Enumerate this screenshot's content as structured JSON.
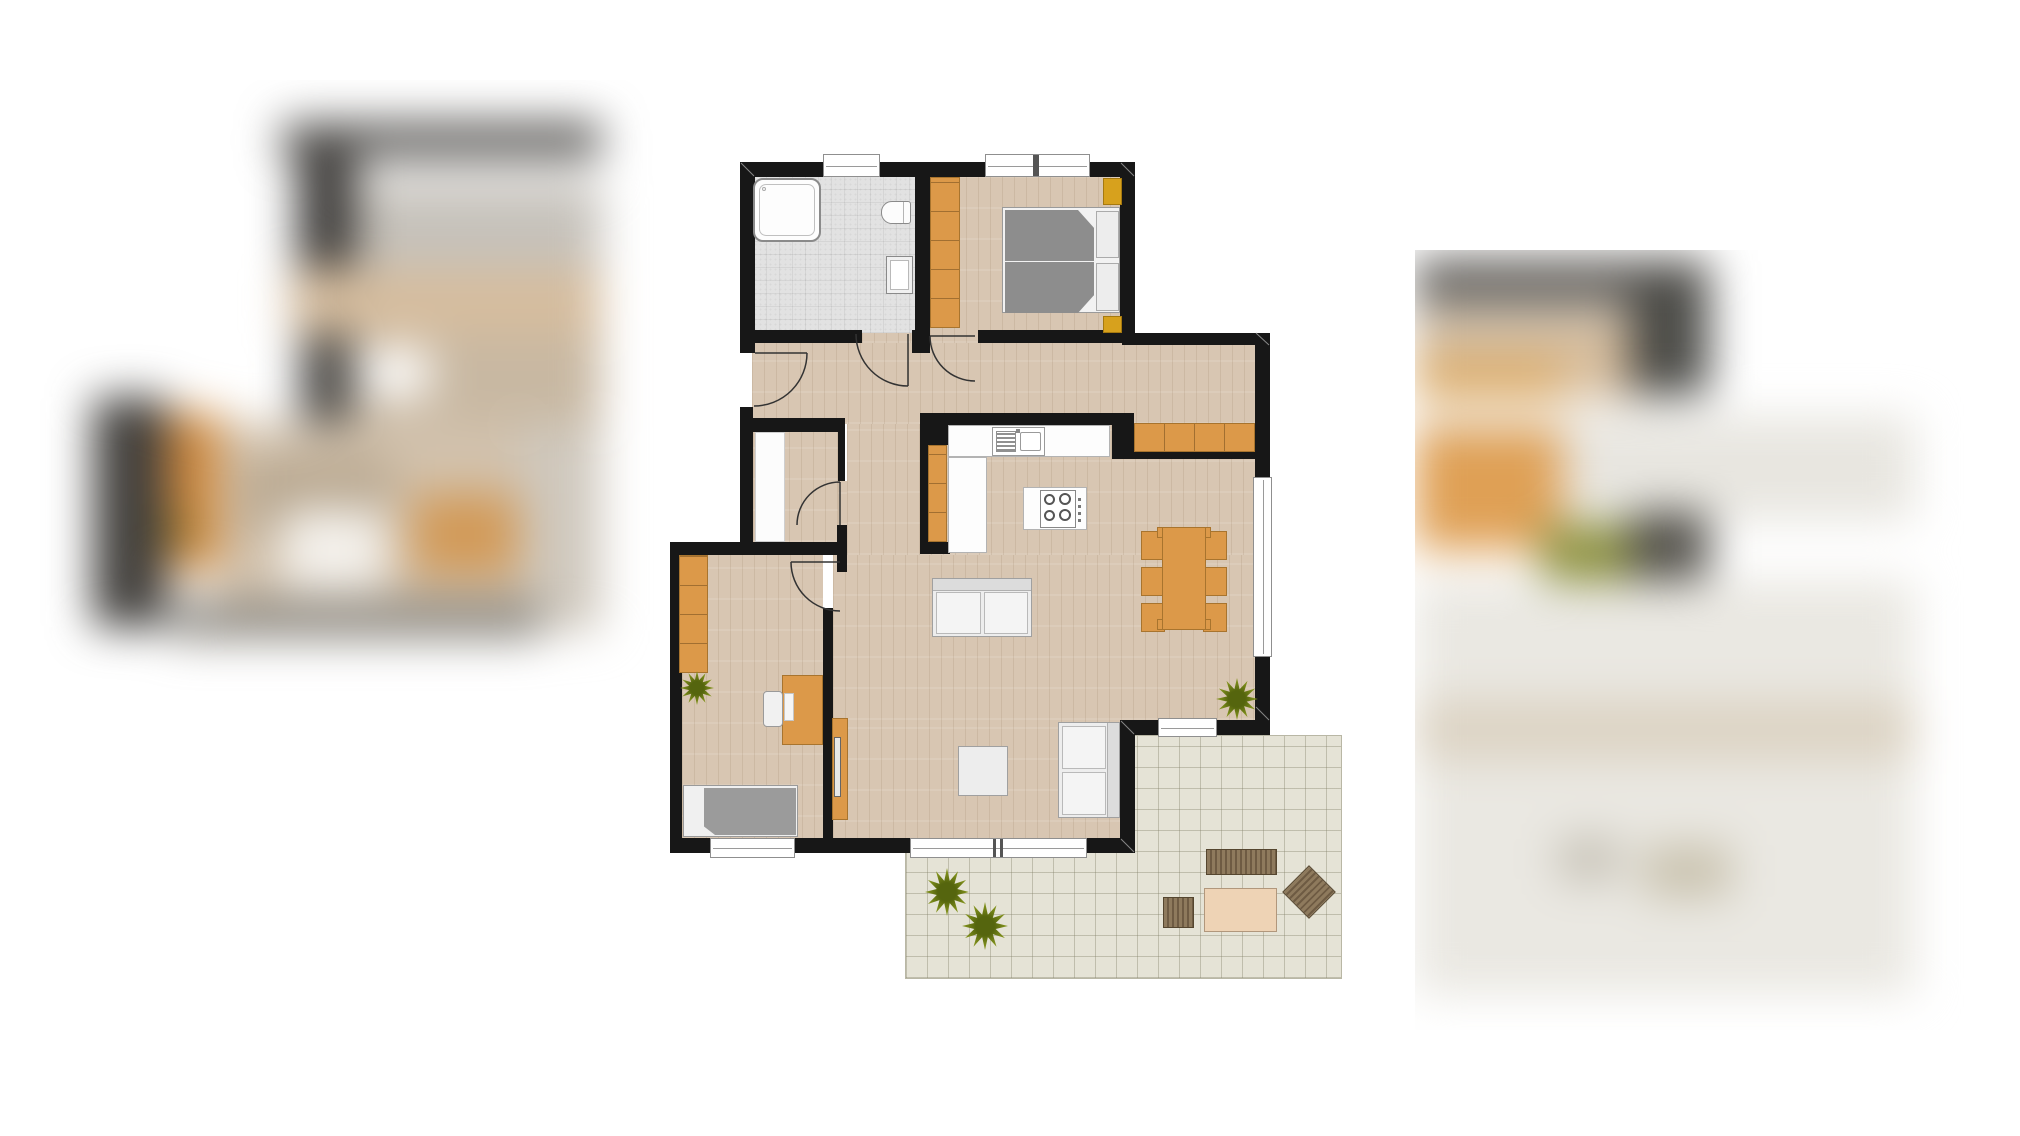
{
  "viewer": {
    "kind": "real-estate image viewer showing a floor plan, flanked by blurred adjacent gallery images",
    "visible_text": "none — the image contains no legible text",
    "left_preview": "blurred fragment of another floor-plan image (dark wall bars, wood and orange furniture tones)",
    "right_preview": "blurred fragment of another floor-plan image (wood band, orange blob, green plant dot, pale terrace area)"
  },
  "palette": {
    "white": "#ffffff",
    "wall": "#171717",
    "wood": "#d8c6b2",
    "tile": "#e2e2e2",
    "terr": "#e5e3d6",
    "terrline": "rgba(130,128,105,0.38)",
    "orange": "#dc9949",
    "orangeb": "#a8742e",
    "gold": "#d7a11d",
    "bed_gray": "#8d8d8d",
    "sofa_gray": "#9b9b9b",
    "plant_green": "#7f8f1b",
    "garden_brown": "#7d6a50",
    "garden_table_tan": "#eed3b5"
  },
  "floorplan": {
    "rooms": [
      {
        "id": "bathroom",
        "label": "bathroom",
        "floor": "gray tile",
        "furniture": [
          "bathtub",
          "toilet",
          "washbasin"
        ],
        "openings": [
          "window-north",
          "door-to-hallway"
        ]
      },
      {
        "id": "bedroom",
        "label": "bedroom",
        "floor": "wood",
        "furniture": [
          "wardrobe",
          "double-bed",
          "pillow",
          "pillow",
          "nightstand-north",
          "nightstand-south"
        ],
        "openings": [
          "window-north",
          "door-to-hallway"
        ]
      },
      {
        "id": "hallway",
        "label": "hallway / corridor",
        "floor": "wood",
        "furniture": [
          "tall-cabinet"
        ],
        "openings": [
          "entrance-door-west",
          "door-bathroom",
          "door-bedroom",
          "door-storage",
          "door-office"
        ]
      },
      {
        "id": "storage",
        "label": "storage closet",
        "floor": "wood",
        "furniture": [
          "built-in-cupboard"
        ],
        "openings": [
          "door-to-hallway"
        ]
      },
      {
        "id": "office",
        "label": "office / second bedroom",
        "floor": "wood",
        "furniture": [
          "shelf-unit",
          "plant",
          "desk",
          "desk-chair",
          "daybed"
        ],
        "openings": [
          "window-south",
          "door-to-hallway"
        ]
      },
      {
        "id": "kitchen",
        "label": "open kitchen",
        "floor": "wood",
        "furniture": [
          "counter-with-sink",
          "side-counter",
          "cooktop-island",
          "sideboard"
        ],
        "openings": [
          "open-to-living"
        ]
      },
      {
        "id": "living_dining",
        "label": "living / dining room",
        "floor": "wood",
        "furniture": [
          "dining-table",
          "dining-chair x6",
          "sofa",
          "coffee-table",
          "loveseat",
          "tv-lowboard",
          "plant"
        ],
        "openings": [
          "window-east",
          "window-south",
          "terrace-door"
        ]
      },
      {
        "id": "terrace",
        "label": "terrace",
        "floor": "beige tile",
        "furniture": [
          "garden-bench",
          "garden-table",
          "garden-chair",
          "garden-chair-rotated",
          "plant",
          "plant"
        ]
      }
    ]
  }
}
